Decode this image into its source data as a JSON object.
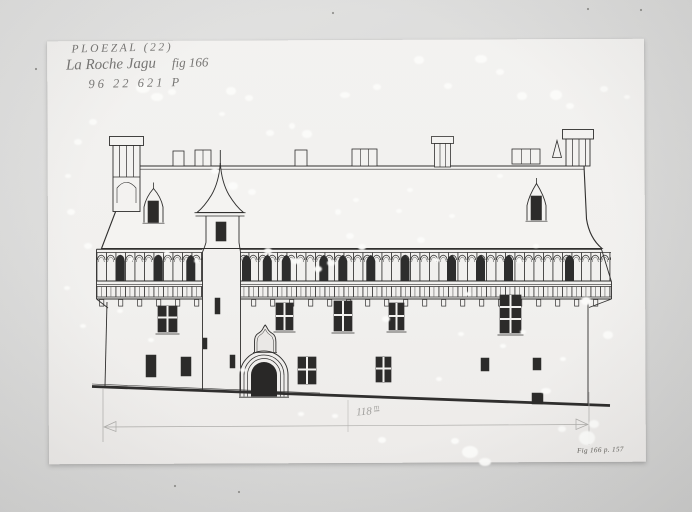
{
  "image": {
    "kind": "archival-photo-of-architectural-drawing",
    "background_color": "#d8d8d6",
    "sheet_color": "#f1f0ee",
    "ink_color": "#222120",
    "pencil_color": "#9b9a97"
  },
  "annotations": {
    "commune": "PLOEZAL (22)",
    "title": "La Roche Jagu",
    "figure_ref": "fig 166",
    "inventory_number": "96 22 621 P",
    "scale_value": "118",
    "scale_unit": "m",
    "caption": "Fig 166 p. 157"
  },
  "drawing": {
    "subject": "castle-facade-elevation",
    "features": [
      "steep-roof",
      "ridge-chimney-stacks",
      "corner-chimneys",
      "central-turret-conical-spire",
      "machicolated-gallery",
      "dormer-windows",
      "cross-mullioned-windows",
      "gothic-entrance-portal",
      "ogee-niche",
      "ground-line",
      "pencil-dimension-line"
    ]
  },
  "damage_spots": [
    [
      143,
      88,
      7,
      5
    ],
    [
      157,
      97,
      6,
      4
    ],
    [
      172,
      92,
      4,
      3
    ],
    [
      231,
      91,
      5,
      4
    ],
    [
      249,
      98,
      4,
      3
    ],
    [
      222,
      114,
      3,
      2
    ],
    [
      307,
      134,
      5,
      4
    ],
    [
      292,
      126,
      3,
      3
    ],
    [
      345,
      95,
      5,
      3
    ],
    [
      377,
      87,
      4,
      3
    ],
    [
      419,
      60,
      5,
      4
    ],
    [
      448,
      86,
      4,
      3
    ],
    [
      481,
      59,
      6,
      4
    ],
    [
      500,
      72,
      4,
      3
    ],
    [
      522,
      96,
      5,
      4
    ],
    [
      556,
      95,
      6,
      5
    ],
    [
      570,
      106,
      4,
      3
    ],
    [
      604,
      89,
      4,
      3
    ],
    [
      627,
      97,
      3,
      2
    ],
    [
      93,
      122,
      4,
      3
    ],
    [
      78,
      142,
      4,
      3
    ],
    [
      68,
      176,
      3,
      2
    ],
    [
      71,
      212,
      4,
      3
    ],
    [
      88,
      246,
      4,
      3
    ],
    [
      67,
      288,
      3,
      2
    ],
    [
      83,
      326,
      3,
      2
    ],
    [
      215,
      171,
      4,
      3
    ],
    [
      233,
      186,
      5,
      4
    ],
    [
      252,
      192,
      4,
      3
    ],
    [
      270,
      133,
      4,
      3
    ],
    [
      296,
      261,
      5,
      3
    ],
    [
      318,
      269,
      4,
      3
    ],
    [
      331,
      263,
      4,
      3
    ],
    [
      268,
      251,
      4,
      3
    ],
    [
      350,
      236,
      4,
      3
    ],
    [
      362,
      247,
      4,
      3
    ],
    [
      338,
      212,
      3,
      3
    ],
    [
      356,
      200,
      3,
      2
    ],
    [
      386,
      319,
      4,
      3
    ],
    [
      399,
      211,
      3,
      2
    ],
    [
      421,
      240,
      4,
      3
    ],
    [
      437,
      260,
      3,
      2
    ],
    [
      410,
      190,
      3,
      2
    ],
    [
      452,
      216,
      3,
      2
    ],
    [
      468,
      294,
      3,
      2
    ],
    [
      519,
      261,
      3,
      2
    ],
    [
      500,
      176,
      3,
      2
    ],
    [
      536,
      246,
      3,
      2
    ],
    [
      586,
      301,
      5,
      4
    ],
    [
      608,
      335,
      5,
      4
    ],
    [
      546,
      391,
      5,
      3
    ],
    [
      562,
      429,
      4,
      3
    ],
    [
      470,
      452,
      8,
      6
    ],
    [
      485,
      462,
      6,
      4
    ],
    [
      587,
      438,
      8,
      7
    ],
    [
      594,
      424,
      5,
      4
    ],
    [
      455,
      441,
      4,
      3
    ],
    [
      301,
      414,
      3,
      2
    ],
    [
      335,
      416,
      3,
      2
    ],
    [
      382,
      440,
      4,
      3
    ],
    [
      167,
      253,
      3,
      2
    ],
    [
      131,
      259,
      3,
      2
    ],
    [
      197,
      261,
      3,
      2
    ],
    [
      120,
      311,
      3,
      2
    ],
    [
      151,
      340,
      3,
      2
    ],
    [
      243,
      370,
      3,
      2
    ],
    [
      461,
      334,
      3,
      2
    ],
    [
      503,
      346,
      3,
      2
    ],
    [
      439,
      379,
      3,
      2
    ],
    [
      523,
      332,
      3,
      2
    ],
    [
      563,
      359,
      3,
      2
    ]
  ],
  "dark_specks": [
    [
      333,
      13
    ],
    [
      588,
      9
    ],
    [
      641,
      10
    ],
    [
      239,
      492
    ],
    [
      175,
      486
    ],
    [
      36,
      69
    ]
  ]
}
